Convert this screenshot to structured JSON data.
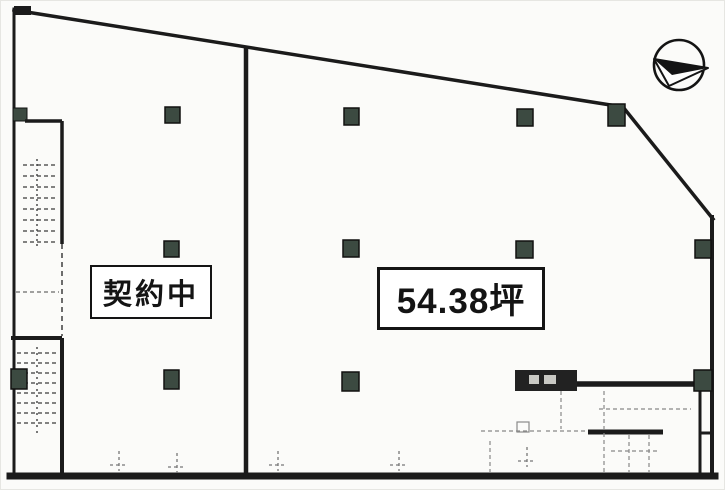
{
  "document": {
    "type": "floor-plan-scan"
  },
  "labels": {
    "left_unit": "契約中",
    "right_unit": "54.38坪"
  },
  "icons": {
    "north_arrow": "north-arrow"
  },
  "colors": {
    "wall": "#1b1b1b",
    "column_fill": "#3c4a41",
    "column_stroke": "#111111",
    "faint_line": "#777777",
    "paper": "#fbfbf9"
  },
  "columns": [
    {
      "x": 164,
      "y": 106,
      "w": 15,
      "h": 16
    },
    {
      "x": 343,
      "y": 107,
      "w": 15,
      "h": 17
    },
    {
      "x": 516,
      "y": 108,
      "w": 16,
      "h": 17
    },
    {
      "x": 607,
      "y": 103,
      "w": 17,
      "h": 22
    },
    {
      "x": 163,
      "y": 240,
      "w": 15,
      "h": 16
    },
    {
      "x": 342,
      "y": 239,
      "w": 16,
      "h": 17
    },
    {
      "x": 515,
      "y": 240,
      "w": 17,
      "h": 17
    },
    {
      "x": 694,
      "y": 239,
      "w": 16,
      "h": 18
    },
    {
      "x": 10,
      "y": 368,
      "w": 16,
      "h": 20
    },
    {
      "x": 163,
      "y": 369,
      "w": 15,
      "h": 19
    },
    {
      "x": 341,
      "y": 371,
      "w": 17,
      "h": 19
    },
    {
      "x": 693,
      "y": 369,
      "w": 18,
      "h": 21
    }
  ],
  "door_marks": [
    {
      "x": 118,
      "y": 450
    },
    {
      "x": 176,
      "y": 452
    },
    {
      "x": 277,
      "y": 450
    },
    {
      "x": 398,
      "y": 450
    },
    {
      "x": 526,
      "y": 446
    }
  ]
}
